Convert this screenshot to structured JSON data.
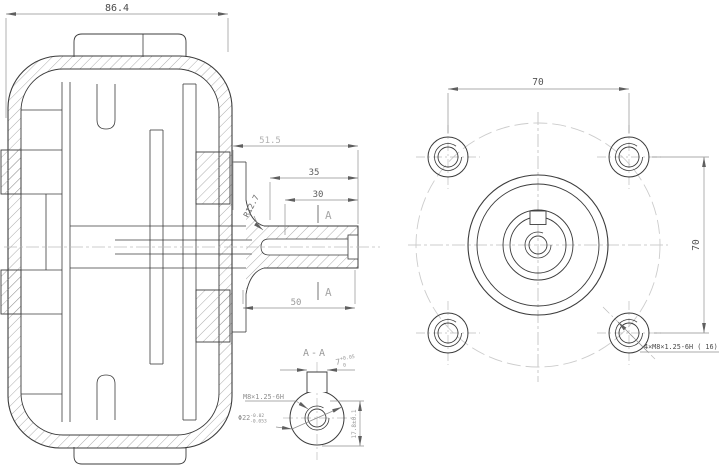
{
  "meta": {
    "background": "#ffffff",
    "line_color": "#3c3c3c",
    "dim_color": "#8f8f8f",
    "centerline_color": "#bcbcbc",
    "phantom_color": "#cccccc"
  },
  "side_view": {
    "dim_overall_width": "86.4",
    "dim_shaft_51_5": "51.5",
    "dim_shaft_35": "35",
    "dim_shaft_30": "30",
    "dim_shaft_50": "50",
    "fillet_label": "R12.7",
    "section_marker_top": "A",
    "section_marker_bottom": "A"
  },
  "front_view": {
    "dim_bolt_horizontal": "70",
    "dim_bolt_vertical": "70",
    "bolt_note": "4×M8×1.25-6H ( 16)"
  },
  "section_view": {
    "title": "A-A",
    "thread_label": "M8×1.25-6H",
    "bore_label": "Φ22",
    "bore_tol_upper": "-0.02",
    "bore_tol_lower": "-0.053",
    "key_width": "7",
    "key_width_tol_upper": "+0.05",
    "key_width_tol_lower": "0",
    "key_depth_label": "17.8±0.1"
  }
}
